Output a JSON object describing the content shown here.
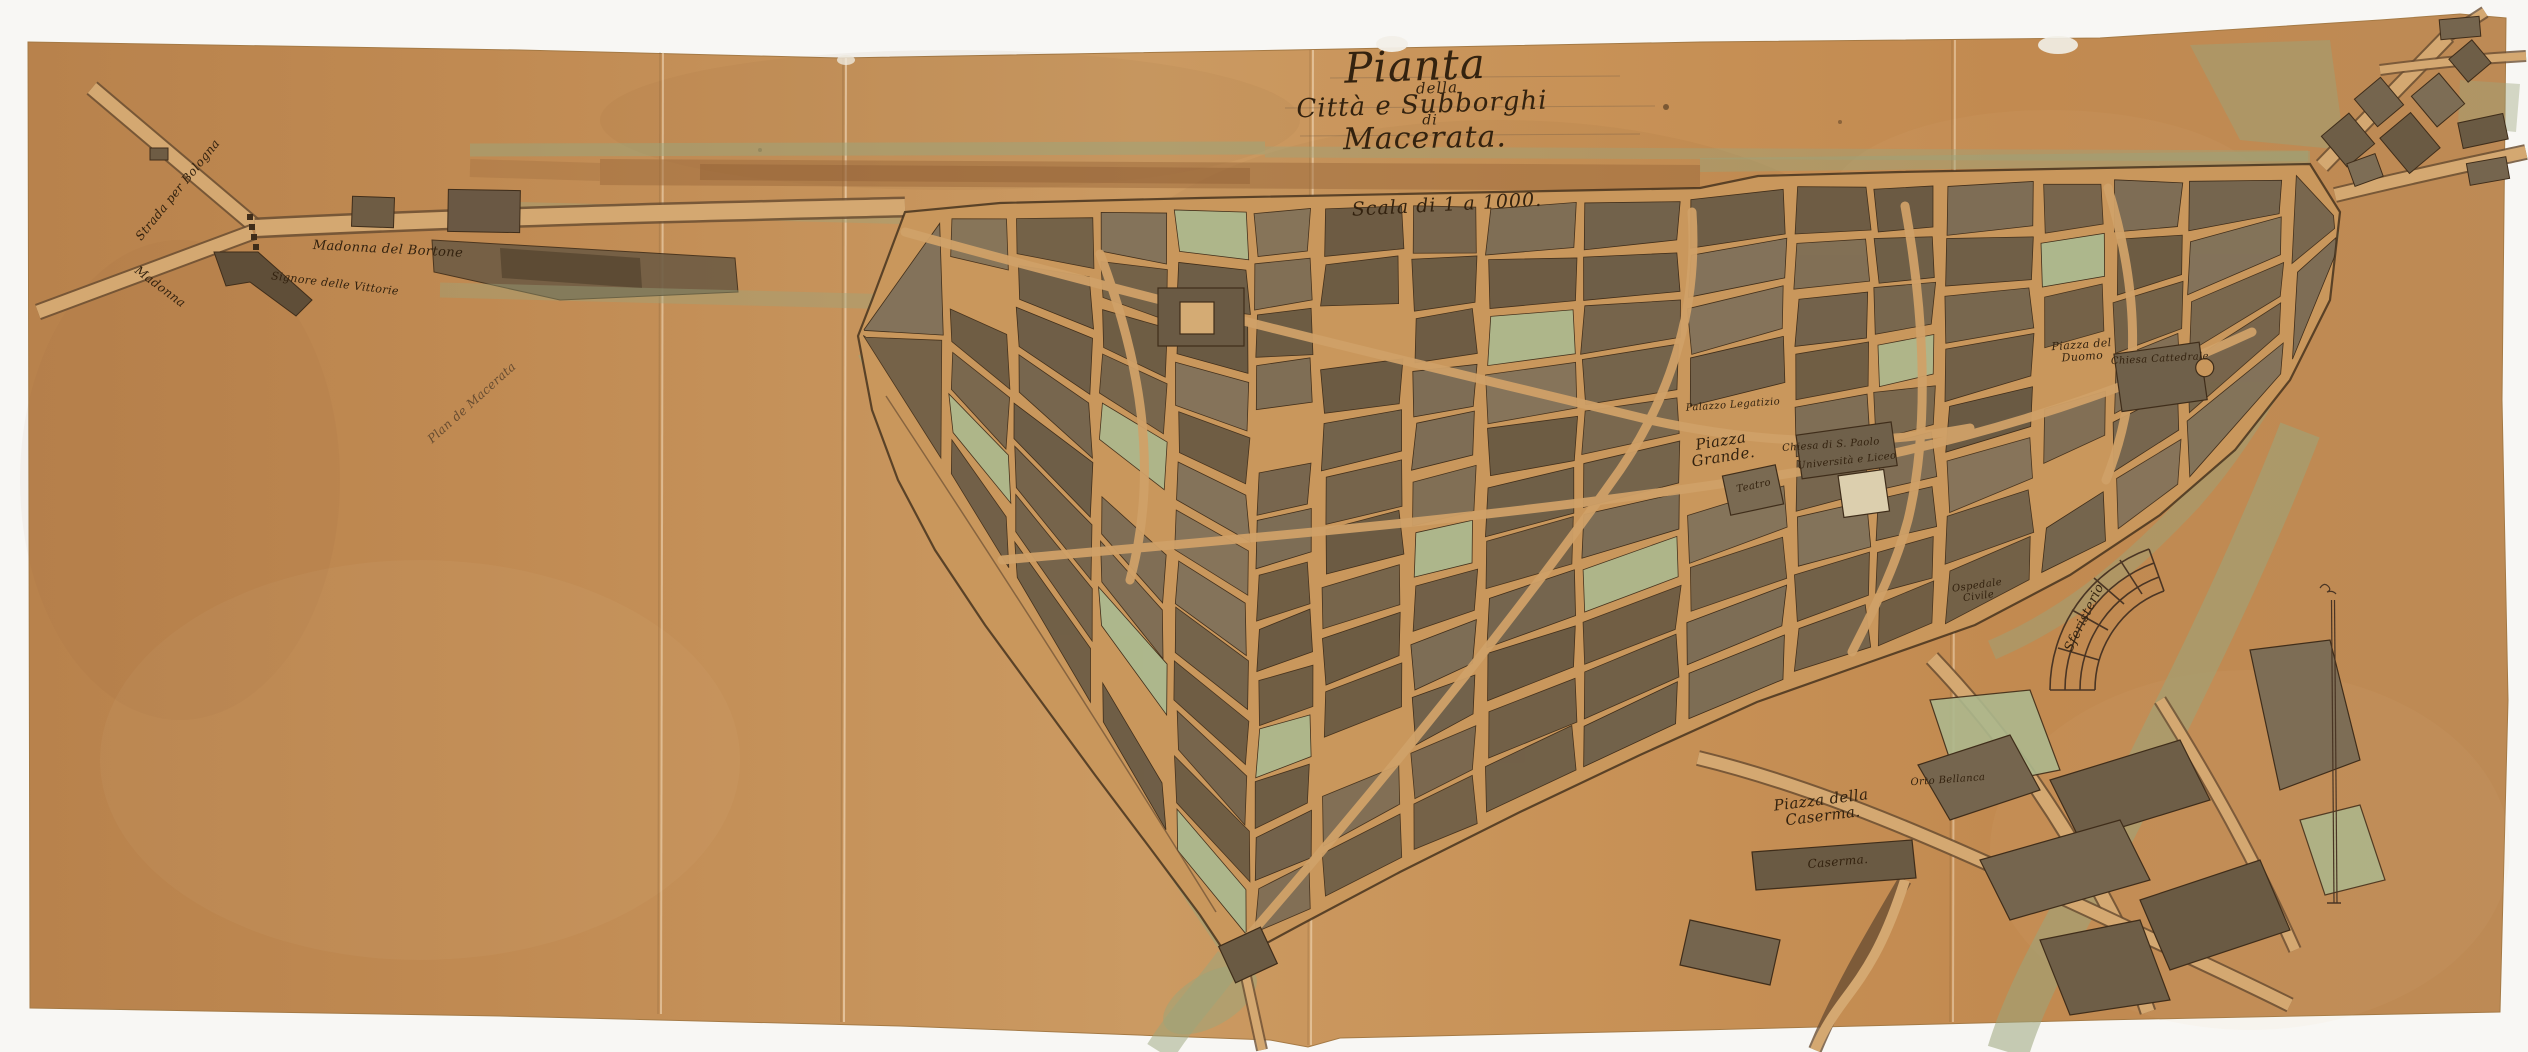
{
  "document": {
    "type": "hand-drawn historical city map, ink and wash on tan paper",
    "language": "Italian"
  },
  "title": {
    "line1": "Pianta",
    "line2": "della",
    "line3": "Città e Subborghi",
    "line4": "di",
    "line5": "Macerata.",
    "scale": "Scala di 1 a 1000."
  },
  "map": {
    "colors": {
      "paper": "#c6925a",
      "paper_dark": "#b37f48",
      "paper_light": "#d2a56c",
      "ink": "#33220f",
      "building": "#75654e",
      "garden_green": "#adb88d",
      "wash_green": "#9aa57c",
      "road_band_brown": "#9c6a3c",
      "pencil": "rgba(80,60,40,0.75)",
      "scan_background": "#f8f7f4"
    },
    "labels": [
      {
        "name": "inscription-plan-de-macerata",
        "text": "Plan de Macerata",
        "x": 472,
        "y": 403,
        "rot": -42,
        "size": 12,
        "color": "rgba(80,60,40,0.8)"
      },
      {
        "name": "road-label-strada-per-bologna",
        "text": "Strada per Bologna",
        "x": 178,
        "y": 190,
        "rot": -51,
        "size": 12
      },
      {
        "name": "road-label-madonna",
        "text": "Madonna",
        "x": 160,
        "y": 287,
        "rot": 37,
        "size": 12
      },
      {
        "name": "road-label-madonna-del-bortone",
        "text": "Madonna  del  Bortone",
        "x": 388,
        "y": 250,
        "rot": 3,
        "size": 13
      },
      {
        "name": "area-label-signore-delle-vittorie",
        "text": "Signore delle Vittorie",
        "x": 335,
        "y": 284,
        "rot": 7,
        "size": 11
      },
      {
        "name": "piazza-grande-label",
        "text": "Piazza\nGrande.",
        "x": 1722,
        "y": 449,
        "rot": -9,
        "size": 15
      },
      {
        "name": "palazzo-legatizio-label",
        "text": "Palazzo Legatizio",
        "x": 1733,
        "y": 406,
        "rot": -4,
        "size": 10
      },
      {
        "name": "chiesa-s-paolo-label",
        "text": "Chiesa di S. Paolo",
        "x": 1831,
        "y": 446,
        "rot": -4,
        "size": 10
      },
      {
        "name": "universita-e-liceo-label",
        "text": "Università e Liceo",
        "x": 1847,
        "y": 462,
        "rot": -6,
        "size": 10
      },
      {
        "name": "teatro-label",
        "text": "Teatro",
        "x": 1754,
        "y": 487,
        "rot": -12,
        "size": 10
      },
      {
        "name": "piazza-del-duomo-label",
        "text": "Piazza del\nDuomo",
        "x": 2082,
        "y": 351,
        "rot": -4,
        "size": 11
      },
      {
        "name": "chiesa-cattedrale-label",
        "text": "Chiesa Cattedrale",
        "x": 2160,
        "y": 360,
        "rot": -3,
        "size": 10
      },
      {
        "name": "sferisterio-label",
        "text": "Sferisterio",
        "x": 2085,
        "y": 618,
        "rot": -64,
        "size": 13
      },
      {
        "name": "ospedale-civile-label",
        "text": "Ospedale\nCivile",
        "x": 1978,
        "y": 592,
        "rot": -8,
        "size": 10
      },
      {
        "name": "piazza-della-caserma-label",
        "text": "Piazza della\nCaserma.",
        "x": 1822,
        "y": 808,
        "rot": -7,
        "size": 15
      },
      {
        "name": "caserma-label",
        "text": "Caserma.",
        "x": 1838,
        "y": 862,
        "rot": -5,
        "size": 12
      },
      {
        "name": "orto-bellanca-label",
        "text": "Orto Bellanca",
        "x": 1948,
        "y": 781,
        "rot": -4,
        "size": 10
      }
    ]
  }
}
